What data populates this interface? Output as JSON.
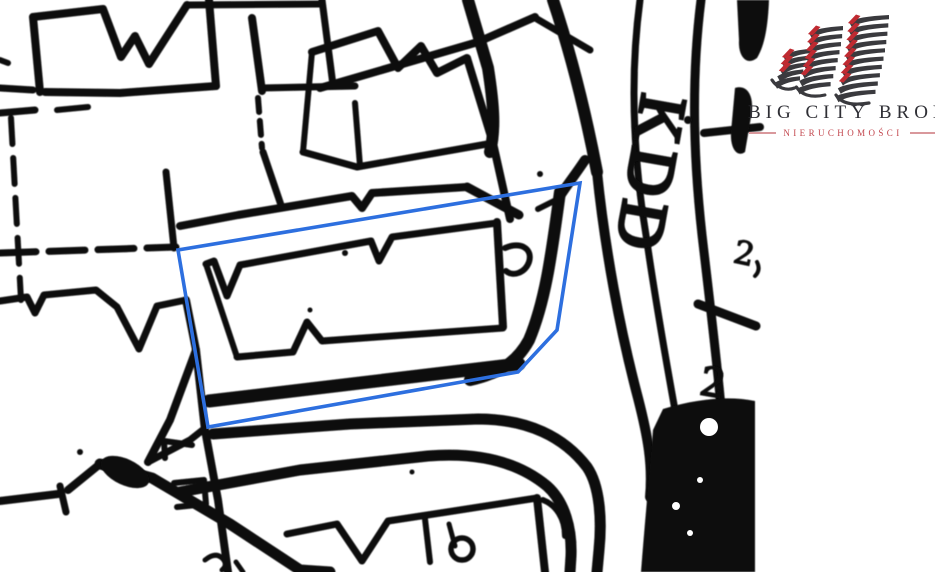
{
  "brand": {
    "name": "BIG CITY BROKER",
    "tagline": "NIERUCHOMOŚCI",
    "accent_color": "#bf2a31",
    "dark_color": "#3a3a3e"
  },
  "map": {
    "street_label": "KDD",
    "parcel_number": "2",
    "boundary_number": "2",
    "highlight_color": "#2d6fdf",
    "line_color": "#0b0b0b"
  }
}
